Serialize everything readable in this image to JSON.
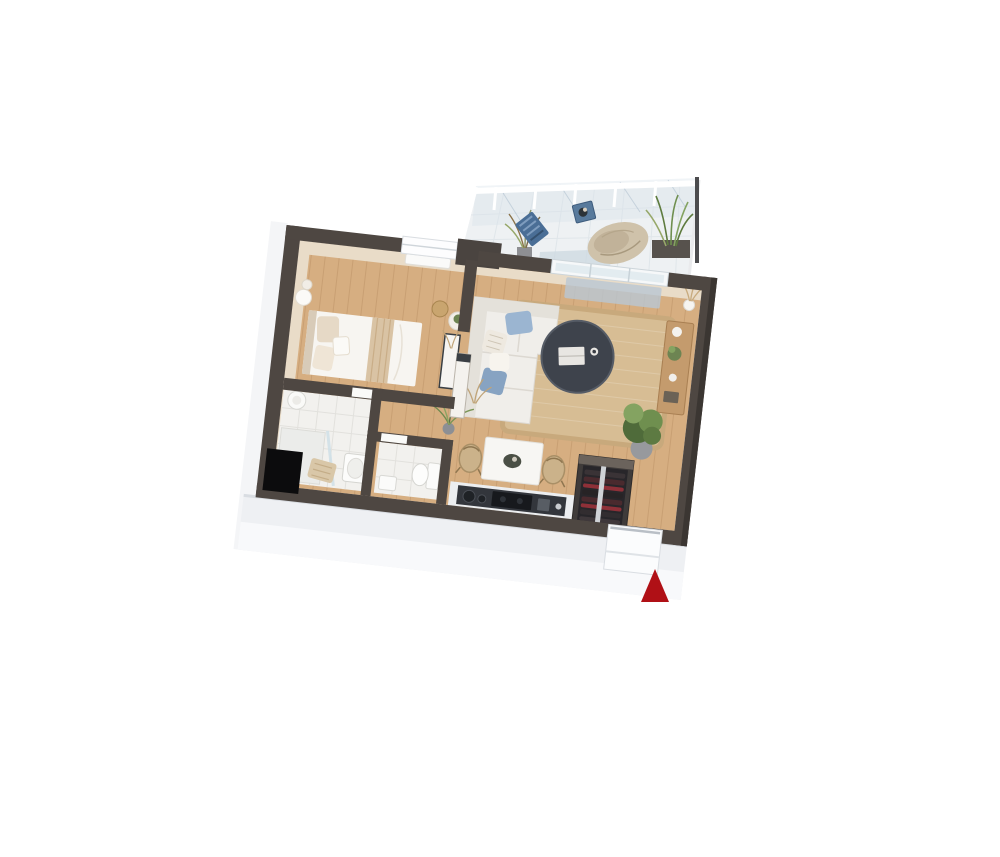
{
  "view": {
    "projection": "3d-top-down-floor-plan",
    "rotation_deg": 6.5,
    "background": "#ffffff"
  },
  "floorplan": {
    "colors": {
      "wall_dark": "#4e4742",
      "wall_darker": "#3b3632",
      "wall_face": "#e9dcc8",
      "floor_wood": "#d6ae81",
      "tile": "#f2f1ee",
      "slab_face": "#eef0f3",
      "slab_face_light": "#f8f9fb",
      "balcony_floor": "#eef1f3",
      "glass": "#d7e2eb",
      "railing_white": "#ffffff",
      "rug": "#d7bd94",
      "rug_border": "#c8a97c",
      "sofa": "#f0eeea",
      "sofa_shadow": "#dfdbd4",
      "cushion_blue": "#9bb5d1",
      "cushion_blue_dark": "#87a3c2",
      "coffee_table": "#3e434c",
      "dining_table": "#f7f6f3",
      "chair_rattan": "#cbb28a",
      "sideboard": "#c49b6d",
      "plant_green": "#5d7a42",
      "plant_green_light": "#84a361",
      "plant_pot": "#97999d",
      "counter_dark": "#33363c",
      "cooktop": "#17191d",
      "wardrobe": "#3f3b3a",
      "wardrobe_top": "#6b635c",
      "wardrobe_inner": "#28262a",
      "clothes_red": "#8e3038",
      "bed_white": "#f7f5f1",
      "bed_throw": "#d9c3a4",
      "pillow_beige": "#e6d9c6",
      "towel": "#d9c7a8",
      "heater_white": "#fafaf8",
      "chair_blue": "#4a6e96",
      "table_blue": "#587a9c",
      "beanbag": "#cfc2aa",
      "mat_blue": "#b9c7d3",
      "door_white": "#fbfcfd",
      "marker_red": "#b01016"
    },
    "rooms": [
      {
        "id": "balcony",
        "name": "balcony-terrace",
        "features": [
          "glass-railing",
          "outdoor-chair-blue",
          "outdoor-side-table-blue",
          "bean-bag-lounger",
          "grass-plant-left",
          "grass-plant-right",
          "planter-box",
          "tiled-floor"
        ]
      },
      {
        "id": "bedroom",
        "name": "bedroom",
        "features": [
          "double-bed",
          "headboard",
          "pillows",
          "striped-throw",
          "nightstand",
          "lamp",
          "wicker-basket",
          "pouf-with-plant",
          "window"
        ]
      },
      {
        "id": "bathroom",
        "name": "bathroom",
        "features": [
          "shower",
          "glass-screen",
          "water-heater",
          "washbasin",
          "towel",
          "tile-floor",
          "dark-shaft"
        ]
      },
      {
        "id": "wc",
        "name": "wc",
        "features": [
          "toilet",
          "small-basin",
          "tile-floor"
        ]
      },
      {
        "id": "hallway",
        "name": "hallway",
        "features": [
          "half-wall",
          "console-table",
          "dried-plant",
          "palm-plant",
          "wood-floor"
        ]
      },
      {
        "id": "living_dining",
        "name": "living-dining-room",
        "features": [
          "corner-sofa",
          "blue-cushions",
          "round-coffee-table",
          "books",
          "cup",
          "jute-rug",
          "sliding-glass-door",
          "doormat",
          "sideboard",
          "pampas-vase",
          "large-floor-plant",
          "dining-table",
          "rattan-chair-left",
          "rattan-chair-right",
          "centerpiece-bowl",
          "wood-floor"
        ]
      },
      {
        "id": "kitchen",
        "name": "kitchen-corner",
        "features": [
          "counter",
          "dark-worktop",
          "cooktop",
          "sink-bowls",
          "utensil-holder"
        ]
      },
      {
        "id": "entry",
        "name": "entry",
        "features": [
          "open-wardrobe",
          "hanging-clothes",
          "clothes-rail",
          "entrance-door-recess"
        ]
      }
    ],
    "entrance_marker": {
      "shape": "triangle",
      "direction": "up",
      "meaning": "entrance-indicator",
      "color": "#b01016"
    }
  }
}
